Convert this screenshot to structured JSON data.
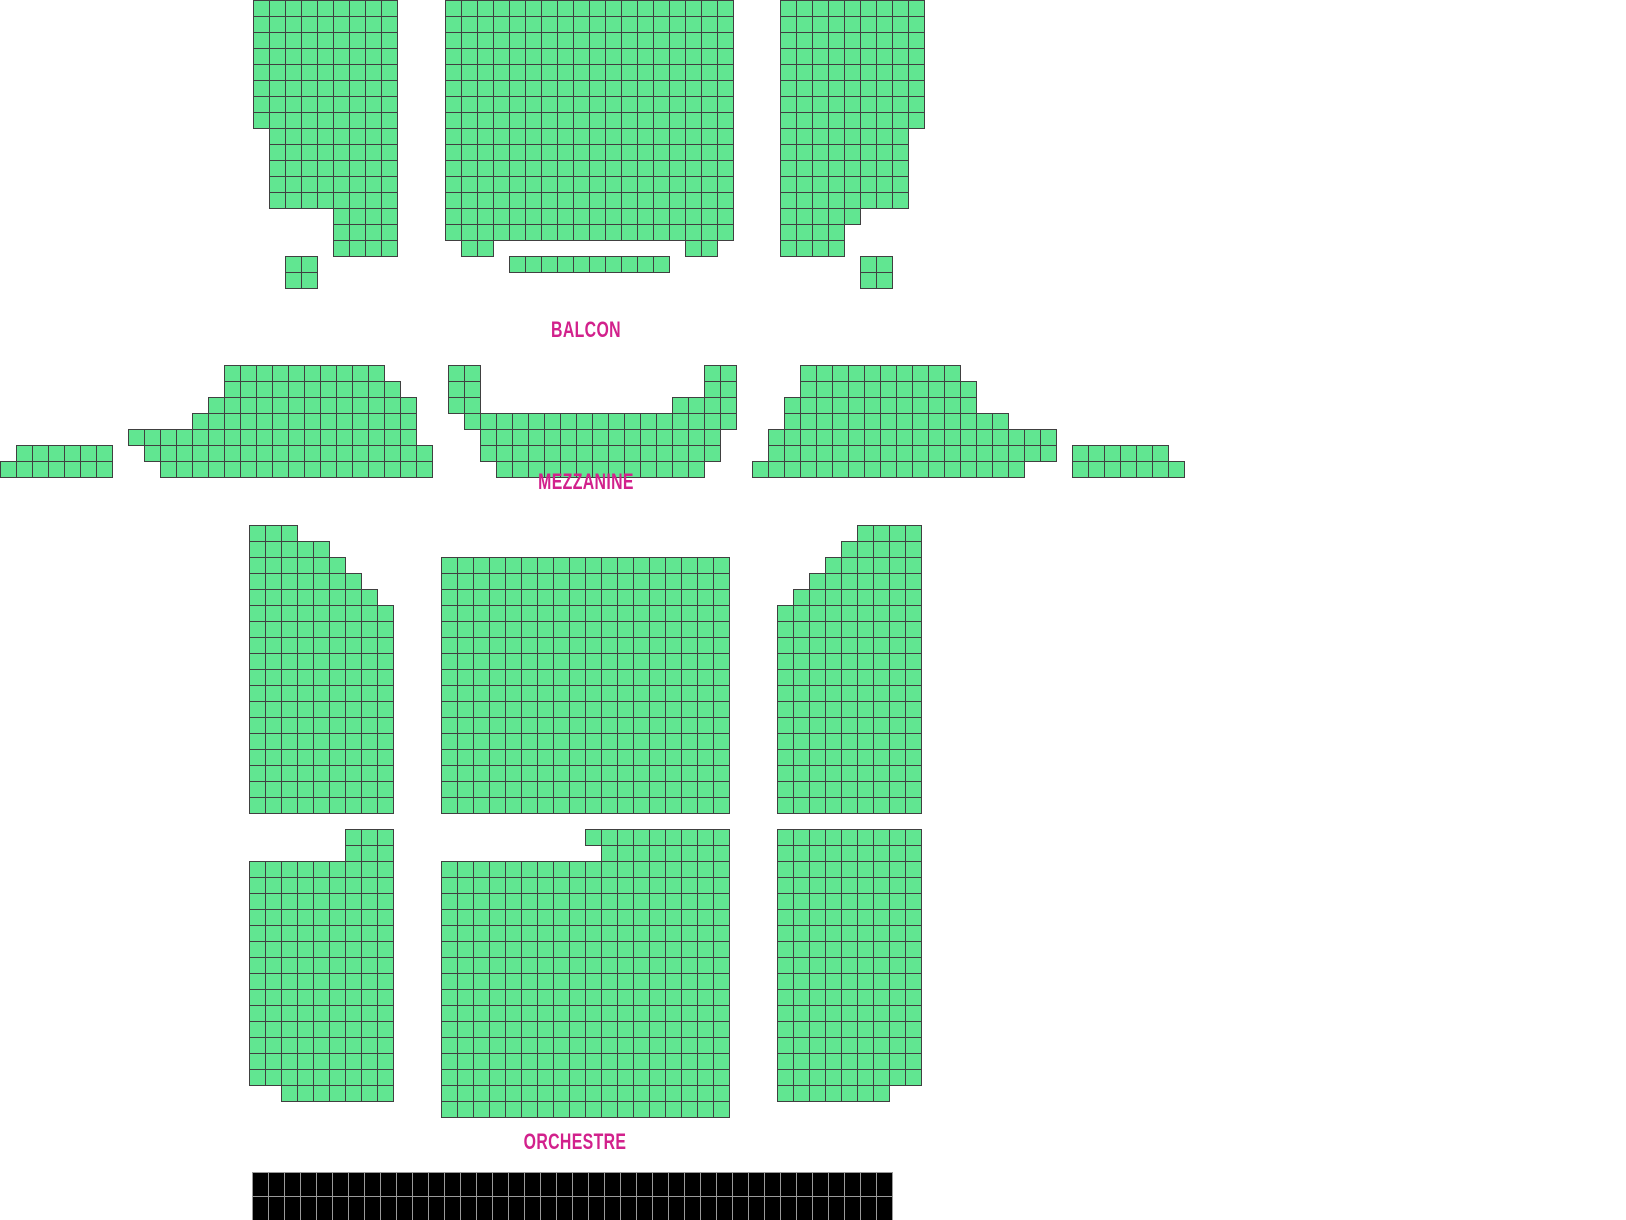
{
  "theme": {
    "background": "#ffffff",
    "seat_fill": "#61e691",
    "seat_border": "#404040",
    "label_color": "#d2218c",
    "stage_fill": "#000000",
    "stage_line": "#9a9a9a"
  },
  "seat_size": 16,
  "sections": [
    {
      "id": "balcon",
      "label": {
        "text": "BALCON",
        "cx": 586,
        "cy": 330
      },
      "blocks": [
        {
          "name": "balcon-left",
          "x": 253,
          "y": 0,
          "rows": [
            {
              "repeat": 8,
              "segs": [
                [
                  0,
                  9
                ]
              ]
            },
            {
              "repeat": 5,
              "segs": [
                [
                  1,
                  8
                ]
              ]
            },
            {
              "repeat": 3,
              "segs": [
                [
                  5,
                  4
                ]
              ]
            }
          ]
        },
        {
          "name": "balcon-left-box",
          "x": 285,
          "y": 256,
          "rows": [
            {
              "repeat": 2,
              "segs": [
                [
                  0,
                  2
                ]
              ]
            }
          ]
        },
        {
          "name": "balcon-center",
          "x": 445,
          "y": 0,
          "rows": [
            {
              "repeat": 15,
              "segs": [
                [
                  0,
                  18
                ]
              ]
            },
            {
              "segs": [
                [
                  1,
                  2
                ],
                [
                  15,
                  2
                ]
              ]
            },
            {
              "segs": [
                [
                  4,
                  10
                ]
              ]
            }
          ]
        },
        {
          "name": "balcon-right",
          "x": 780,
          "y": 0,
          "rows": [
            {
              "repeat": 8,
              "segs": [
                [
                  0,
                  9
                ]
              ]
            },
            {
              "repeat": 5,
              "segs": [
                [
                  0,
                  8
                ]
              ]
            },
            {
              "segs": [
                [
                  0,
                  5
                ]
              ]
            },
            {
              "repeat": 2,
              "segs": [
                [
                  0,
                  4
                ]
              ]
            }
          ]
        },
        {
          "name": "balcon-right-box",
          "x": 860,
          "y": 256,
          "rows": [
            {
              "repeat": 2,
              "segs": [
                [
                  0,
                  2
                ]
              ]
            }
          ]
        }
      ]
    },
    {
      "id": "mezzanine",
      "label": {
        "text": "MEZZANINE",
        "cx": 586,
        "cy": 482
      },
      "blocks": [
        {
          "name": "mezzanine-far-left",
          "x": 0,
          "y": 445,
          "rows": [
            {
              "segs": [
                [
                  1,
                  6
                ]
              ]
            },
            {
              "segs": [
                [
                  0,
                  7
                ]
              ]
            }
          ]
        },
        {
          "name": "mezzanine-left",
          "x": 128,
          "y": 365,
          "rows": [
            {
              "segs": [
                [
                  6,
                  10
                ]
              ]
            },
            {
              "segs": [
                [
                  6,
                  11
                ]
              ]
            },
            {
              "segs": [
                [
                  5,
                  13
                ]
              ]
            },
            {
              "segs": [
                [
                  4,
                  14
                ]
              ]
            },
            {
              "segs": [
                [
                  0,
                  18
                ]
              ]
            },
            {
              "segs": [
                [
                  1,
                  18
                ]
              ]
            },
            {
              "segs": [
                [
                  2,
                  17
                ]
              ]
            }
          ]
        },
        {
          "name": "mezzanine-center",
          "x": 448,
          "y": 365,
          "rows": [
            {
              "repeat": 2,
              "segs": [
                [
                  0,
                  2
                ],
                [
                  16,
                  2
                ]
              ]
            },
            {
              "segs": [
                [
                  0,
                  2
                ],
                [
                  14,
                  4
                ]
              ]
            },
            {
              "segs": [
                [
                  1,
                  17
                ]
              ]
            },
            {
              "repeat": 2,
              "segs": [
                [
                  2,
                  15
                ]
              ]
            },
            {
              "segs": [
                [
                  3,
                  13
                ]
              ]
            }
          ]
        },
        {
          "name": "mezzanine-right",
          "x": 752,
          "y": 365,
          "rows": [
            {
              "segs": [
                [
                  3,
                  10
                ]
              ]
            },
            {
              "segs": [
                [
                  3,
                  11
                ]
              ]
            },
            {
              "segs": [
                [
                  2,
                  12
                ]
              ]
            },
            {
              "segs": [
                [
                  2,
                  14
                ]
              ]
            },
            {
              "repeat": 2,
              "segs": [
                [
                  1,
                  18
                ]
              ]
            },
            {
              "segs": [
                [
                  0,
                  17
                ]
              ]
            }
          ]
        },
        {
          "name": "mezzanine-far-right",
          "x": 1072,
          "y": 445,
          "rows": [
            {
              "segs": [
                [
                  0,
                  6
                ]
              ]
            },
            {
              "segs": [
                [
                  0,
                  7
                ]
              ]
            }
          ]
        }
      ]
    },
    {
      "id": "orchestre",
      "label": {
        "text": "ORCHESTRE",
        "cx": 575,
        "cy": 1142
      },
      "blocks": [
        {
          "name": "orchestre-front-left",
          "x": 249,
          "y": 525,
          "rows": [
            {
              "segs": [
                [
                  0,
                  3
                ]
              ]
            },
            {
              "segs": [
                [
                  0,
                  5
                ]
              ]
            },
            {
              "segs": [
                [
                  0,
                  6
                ]
              ]
            },
            {
              "segs": [
                [
                  0,
                  7
                ]
              ]
            },
            {
              "segs": [
                [
                  0,
                  8
                ]
              ]
            },
            {
              "repeat": 13,
              "segs": [
                [
                  0,
                  9
                ]
              ]
            }
          ]
        },
        {
          "name": "orchestre-front-center",
          "x": 441,
          "y": 557,
          "rows": [
            {
              "repeat": 16,
              "segs": [
                [
                  0,
                  18
                ]
              ]
            }
          ]
        },
        {
          "name": "orchestre-front-right",
          "x": 777,
          "y": 525,
          "rows": [
            {
              "segs": [
                [
                  5,
                  4
                ]
              ]
            },
            {
              "segs": [
                [
                  4,
                  5
                ]
              ]
            },
            {
              "segs": [
                [
                  3,
                  6
                ]
              ]
            },
            {
              "segs": [
                [
                  2,
                  7
                ]
              ]
            },
            {
              "segs": [
                [
                  1,
                  8
                ]
              ]
            },
            {
              "repeat": 13,
              "segs": [
                [
                  0,
                  9
                ]
              ]
            }
          ]
        },
        {
          "name": "orchestre-rear-left",
          "x": 249,
          "y": 829,
          "rows": [
            {
              "repeat": 2,
              "segs": [
                [
                  6,
                  3
                ]
              ]
            },
            {
              "repeat": 14,
              "segs": [
                [
                  0,
                  9
                ]
              ]
            },
            {
              "segs": [
                [
                  2,
                  7
                ]
              ]
            }
          ]
        },
        {
          "name": "orchestre-rear-center",
          "x": 441,
          "y": 829,
          "rows": [
            {
              "segs": [
                [
                  9,
                  9
                ]
              ]
            },
            {
              "segs": [
                [
                  10,
                  8
                ]
              ]
            },
            {
              "repeat": 16,
              "segs": [
                [
                  0,
                  18
                ]
              ]
            }
          ]
        },
        {
          "name": "orchestre-rear-right",
          "x": 777,
          "y": 829,
          "rows": [
            {
              "repeat": 16,
              "segs": [
                [
                  0,
                  9
                ]
              ]
            },
            {
              "segs": [
                [
                  0,
                  7
                ]
              ]
            }
          ]
        }
      ]
    }
  ],
  "stage": {
    "x": 252,
    "y": 1172,
    "cols": 40,
    "rows": 2,
    "cell_w": 16,
    "cell_h": 24
  }
}
